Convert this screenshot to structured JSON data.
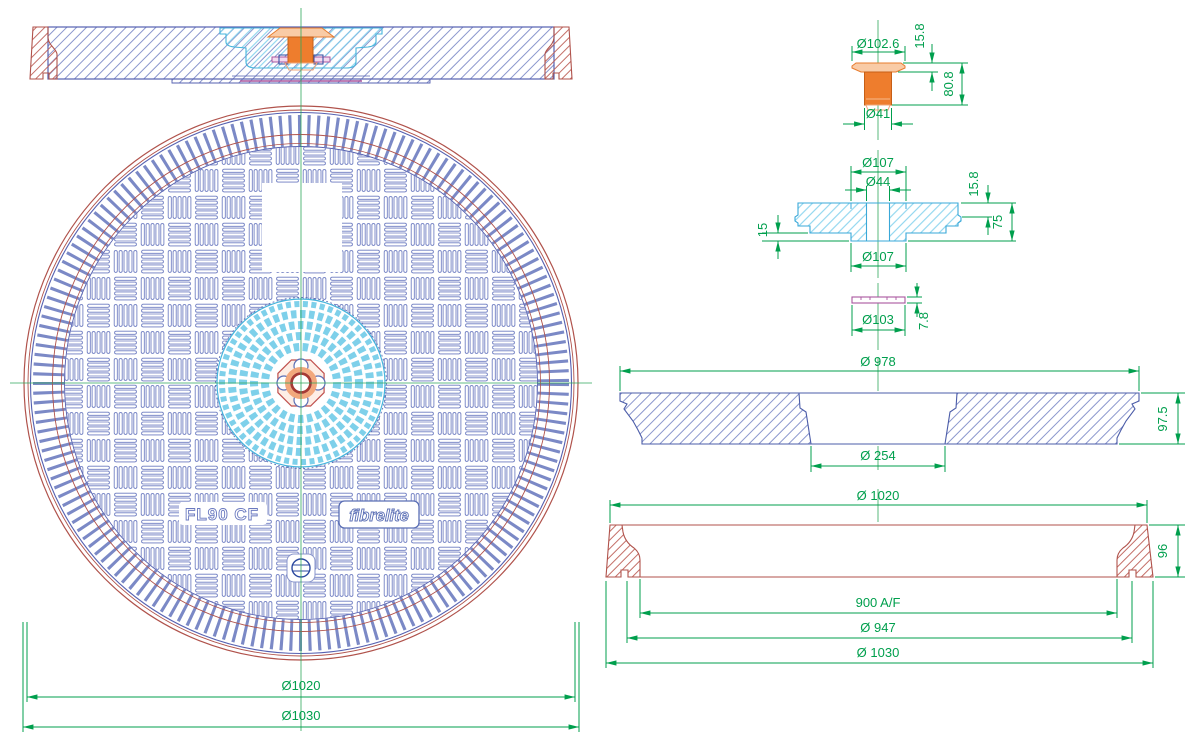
{
  "drawing": {
    "product_label": "FL90 CF",
    "brand_logo": "fibrelite",
    "plan": {
      "dia_cover": "Ø1020",
      "dia_frame": "Ø1030"
    },
    "bolt": {
      "cap_dia": "Ø102.6",
      "cap_h": "15.8",
      "total_h": "80.8",
      "stem_dia": "Ø41"
    },
    "insert": {
      "top_dia": "Ø107",
      "hole_dia": "Ø44",
      "lip_h": "15.8",
      "total_h": "75",
      "step_h": "15",
      "bottom_dia": "Ø107"
    },
    "washer": {
      "thk": "7.8",
      "dia": "Ø103"
    },
    "cover_section": {
      "dia": "Ø 978",
      "h": "97.5",
      "opening": "Ø 254"
    },
    "frame_section": {
      "top_dia": "Ø 1020",
      "h": "96",
      "af": "900 A/F",
      "seat_dia": "Ø 947",
      "base_dia": "Ø 1030"
    }
  },
  "colors": {
    "dimension_green": "#009f4d",
    "centerline_green": "#2fa85b",
    "outline_blue": "#5560b0",
    "pattern_blue": "#6b7ac0",
    "frame_red": "#b0524b",
    "insert_cyan": "#45b4dc",
    "bolt_orange": "#ee7d2d",
    "bolt_cap_peach": "#f9cba6",
    "washer_magenta": "#a9569f"
  }
}
